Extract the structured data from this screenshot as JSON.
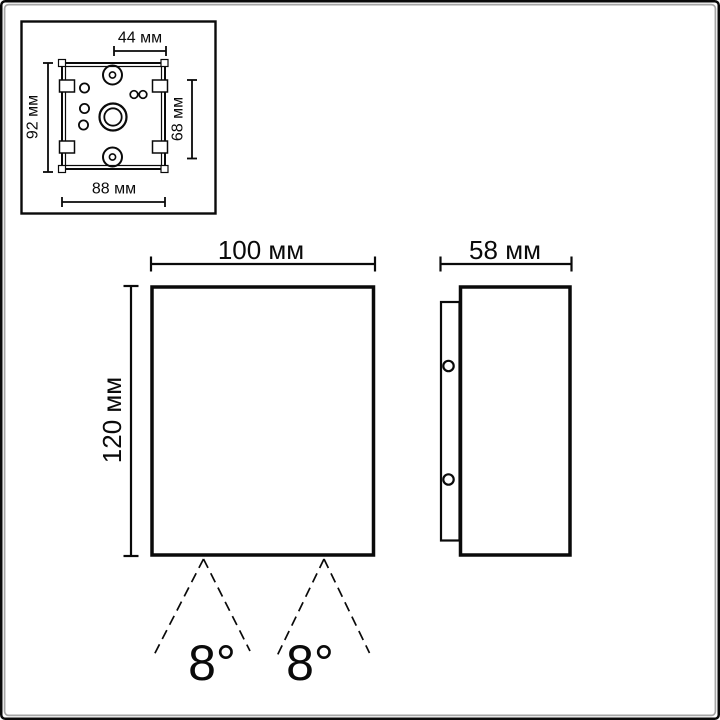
{
  "figure": {
    "type": "technical-dimension-drawing",
    "subject": "wall-mounted luminaire with mounting plate",
    "units": "мм",
    "background_color": "#ffffff",
    "line_color": "#0a0a0a",
    "frame_shadow_color": "#a6a6a6",
    "inset": {
      "description": "mounting plate rear view",
      "dim_top": {
        "label": "44 мм",
        "value": 44,
        "unit": "мм"
      },
      "dim_left": {
        "label": "92 мм",
        "value": 92,
        "unit": "мм"
      },
      "dim_right": {
        "label": "68 мм",
        "value": 68,
        "unit": "мм"
      },
      "dim_bottom": {
        "label": "88 мм",
        "value": 88,
        "unit": "мм"
      }
    },
    "front": {
      "description": "front view of body",
      "dim_width": {
        "label": "100 мм",
        "value": 100,
        "unit": "мм"
      },
      "dim_height": {
        "label": "120 мм",
        "value": 120,
        "unit": "мм"
      }
    },
    "side": {
      "description": "side view of body with wall bracket",
      "dim_depth": {
        "label": "58 мм",
        "value": 58,
        "unit": "мм"
      }
    },
    "beams": {
      "description": "light beam spread angles (dashed cones)",
      "left": {
        "label": "8°",
        "value": 8,
        "unit": "deg"
      },
      "right": {
        "label": "8°",
        "value": 8,
        "unit": "deg"
      }
    }
  }
}
